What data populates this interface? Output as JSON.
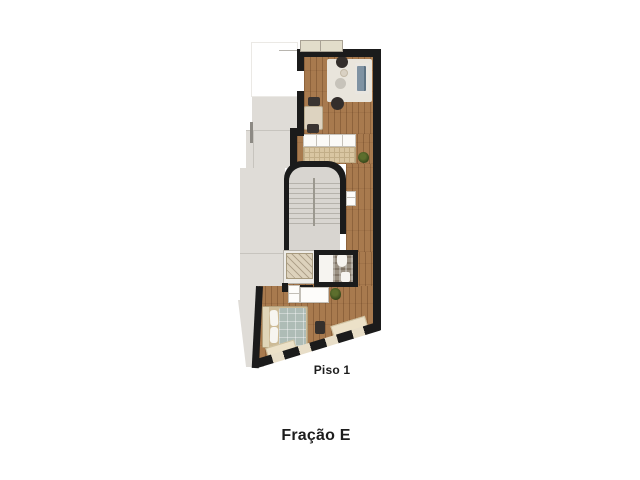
{
  "title": {
    "floor_label": "Piso 1",
    "unit_label": "Fração E"
  },
  "palette": {
    "background": "#ffffff",
    "wall": "#1b1b1b",
    "wood_floor": "#a87a4e",
    "neighbor_gray": "#dfdcd7",
    "stair_gray": "#d8d5d0",
    "rug": "#e9e5dc",
    "sofa_blue": "#7f92a2",
    "bed_duvet": "#aebcb6",
    "bed_frame": "#cdbb97",
    "counter_beige": "#d9c6a2",
    "bath_tile": "#9a9082",
    "window_beige": "#e8dec8",
    "plant_green": "#3a4a1c",
    "label_text": "#1d1d1d"
  }
}
